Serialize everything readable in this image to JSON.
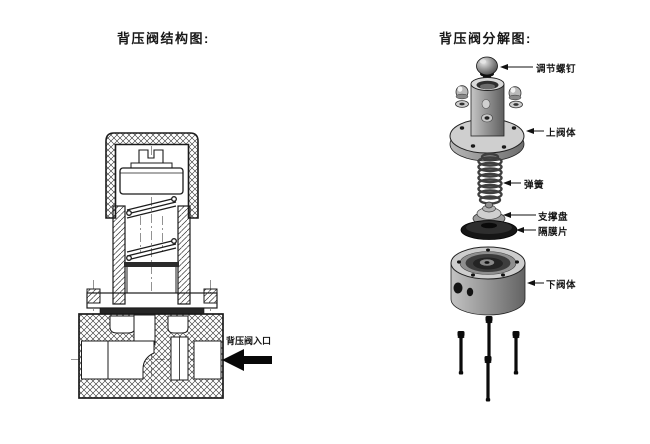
{
  "left_diagram": {
    "title": "背压阀结构图:",
    "inlet_label": "背压阀入口"
  },
  "right_diagram": {
    "title": "背压阀分解图:",
    "labels": {
      "adjusting_screw": "调节螺钉",
      "upper_valve_body": "上阀体",
      "spring": "弹簧",
      "support_plate": "支撑盘",
      "diaphragm": "隔膜片",
      "lower_valve_body": "下阀体"
    }
  },
  "colors": {
    "ink": "#1b1b1b",
    "metal_light": "#d6d6d6",
    "metal_mid": "#9a9a9a",
    "metal_dark": "#5c5c5c",
    "black_part": "#141414"
  }
}
